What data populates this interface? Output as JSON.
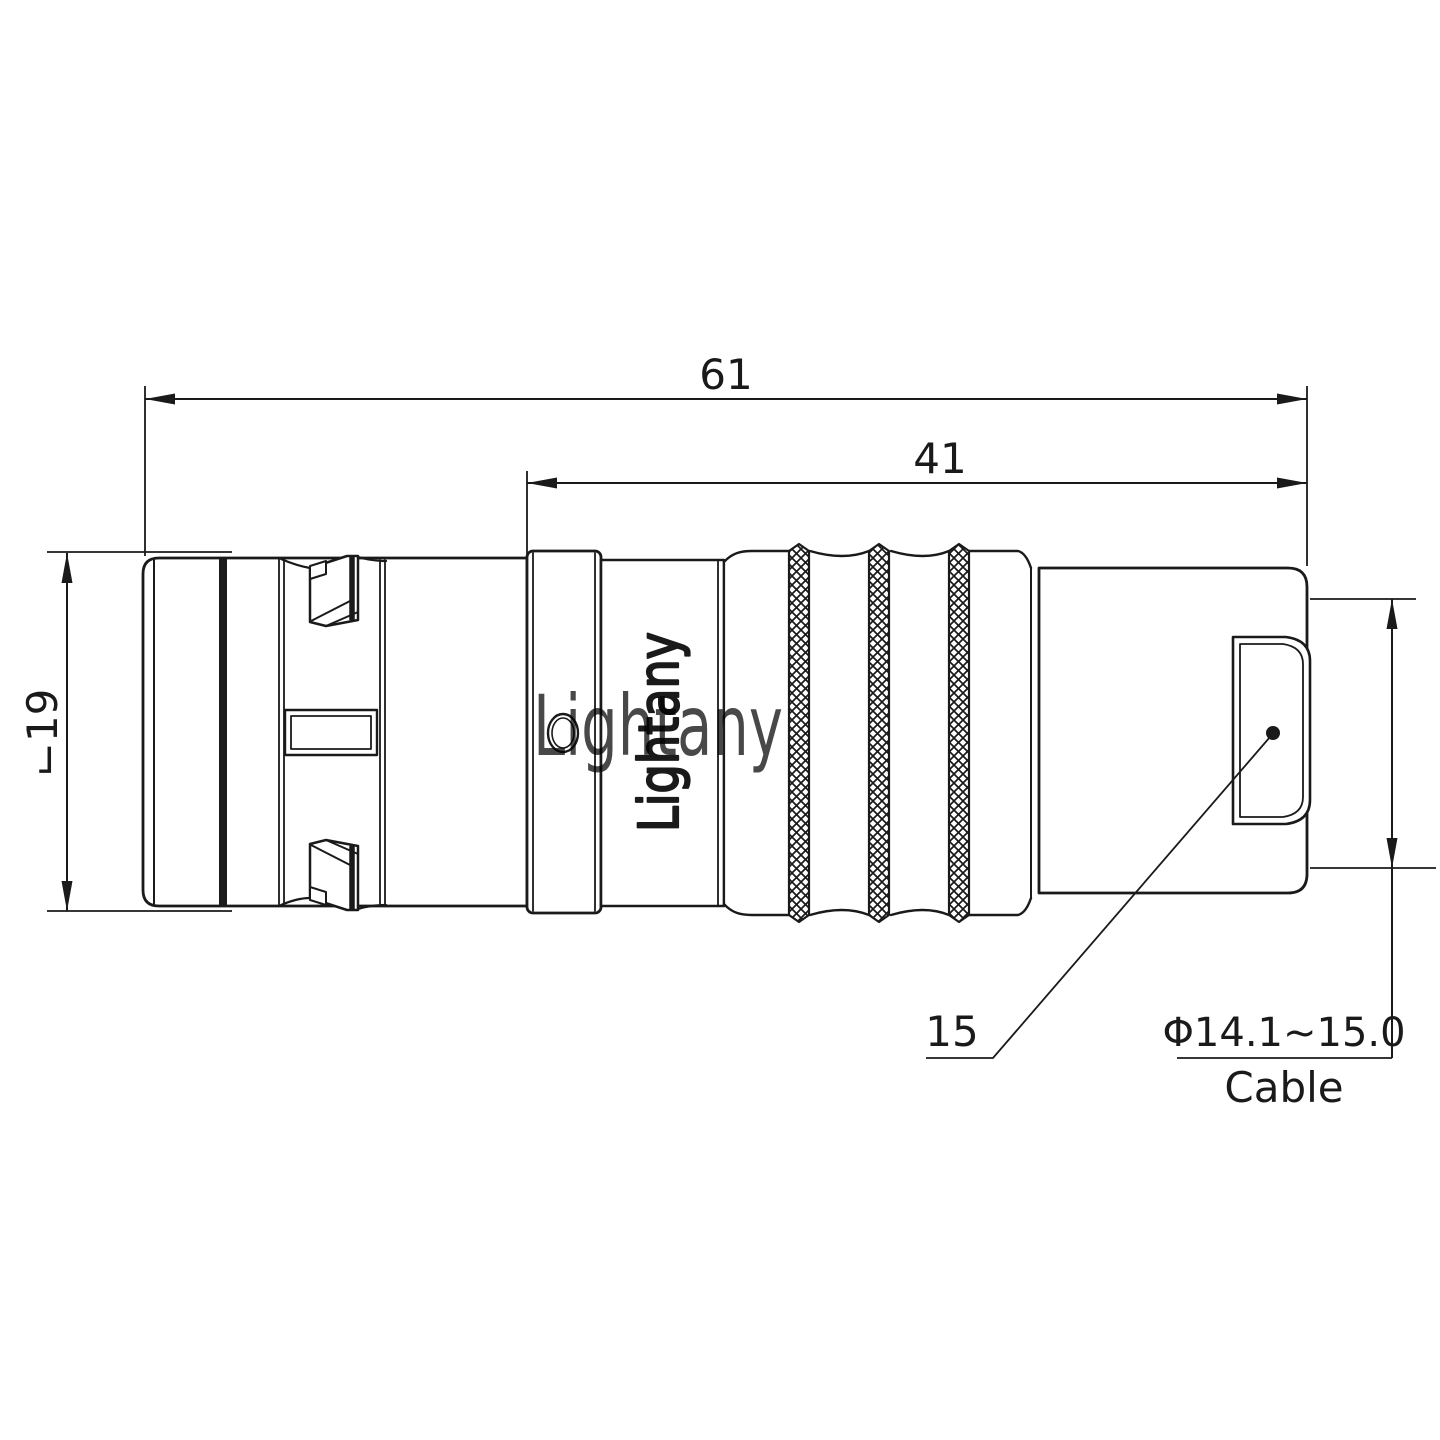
{
  "drawing": {
    "type": "connector engineering drawing",
    "dimensions": {
      "total_length": "61",
      "rear_length": "41",
      "body_diameter": "⌙19",
      "sleeve_diameter": "15",
      "cable_range": "Φ14.1~15.0",
      "cable_label": "Cable"
    },
    "branding": {
      "body_text": "Lightany",
      "watermark": "Lightany"
    },
    "colors": {
      "line": "#1a1a1a",
      "watermark": "#eeb0b0",
      "background": "#ffffff"
    }
  }
}
